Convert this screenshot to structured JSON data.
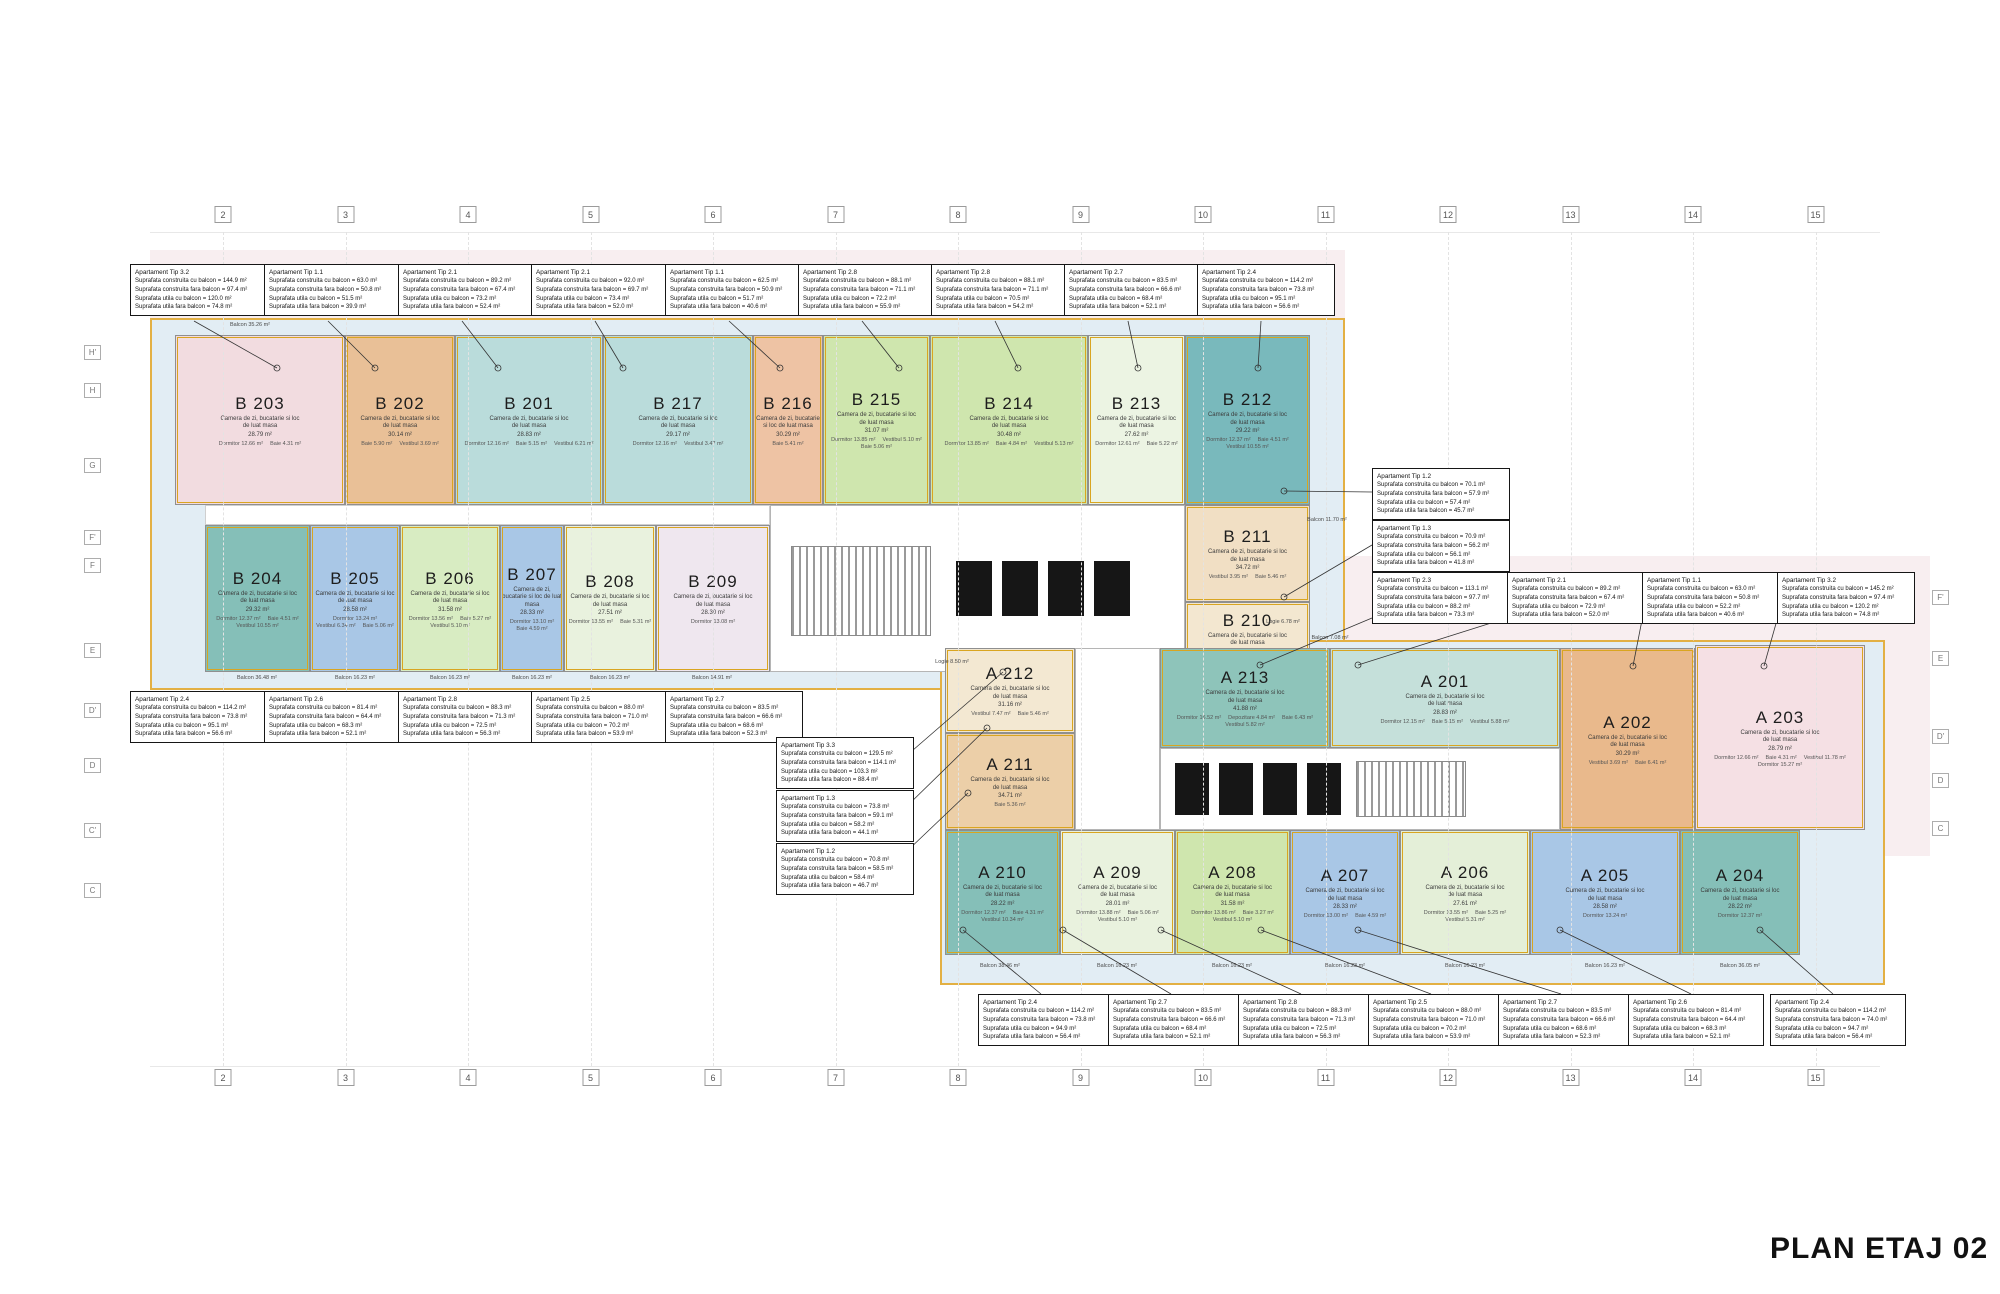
{
  "title": "PLAN ETAJ 02",
  "shared": {
    "main_room_label": "Camera de zi, bucatarie si loc de luat masa",
    "area_unit": "m²",
    "field_labels": [
      "Suprafata construita cu balcon",
      "Suprafata construita fara balcon",
      "Suprafata utila cu balcon",
      "Suprafata utila fara balcon"
    ]
  },
  "annotations": {
    "top": [
      {
        "tip": "Apartament Tip 3.2",
        "values": [
          "144.9",
          "97.4",
          "120.0",
          "74.8"
        ]
      },
      {
        "tip": "Apartament Tip 1.1",
        "values": [
          "63.0",
          "50.8",
          "51.5",
          "39.9"
        ]
      },
      {
        "tip": "Apartament Tip 2.1",
        "values": [
          "89.2",
          "67.4",
          "73.2",
          "52.4"
        ]
      },
      {
        "tip": "Apartament Tip 2.1",
        "values": [
          "92.0",
          "69.7",
          "73.4",
          "52.0"
        ]
      },
      {
        "tip": "Apartament Tip 1.1",
        "values": [
          "62.5",
          "50.9",
          "51.7",
          "40.6"
        ]
      },
      {
        "tip": "Apartament Tip 2.8",
        "values": [
          "88.1",
          "71.1",
          "72.2",
          "55.9"
        ]
      },
      {
        "tip": "Apartament Tip 2.8",
        "values": [
          "88.1",
          "71.1",
          "70.5",
          "54.2"
        ]
      },
      {
        "tip": "Apartament Tip 2.7",
        "values": [
          "83.5",
          "66.6",
          "68.4",
          "52.1"
        ]
      },
      {
        "tip": "Apartament Tip 2.4",
        "values": [
          "114.2",
          "73.8",
          "95.1",
          "56.6"
        ]
      }
    ],
    "right_stack": [
      {
        "tip": "Apartament Tip 1.2",
        "values": [
          "70.1",
          "57.9",
          "57.4",
          "45.7"
        ]
      },
      {
        "tip": "Apartament Tip 1.3",
        "values": [
          "70.9",
          "56.2",
          "56.1",
          "41.8"
        ]
      }
    ],
    "right_row": [
      {
        "tip": "Apartament Tip 2.3",
        "values": [
          "113.1",
          "97.7",
          "88.2",
          "73.3"
        ]
      },
      {
        "tip": "Apartament Tip 2.1",
        "values": [
          "89.2",
          "67.4",
          "72.9",
          "52.0"
        ]
      },
      {
        "tip": "Apartament Tip 1.1",
        "values": [
          "63.0",
          "50.8",
          "52.2",
          "40.6"
        ]
      },
      {
        "tip": "Apartament Tip 3.2",
        "values": [
          "145.2",
          "97.4",
          "120.2",
          "74.8"
        ]
      }
    ],
    "left_row": [
      {
        "tip": "Apartament Tip 2.4",
        "values": [
          "114.2",
          "73.8",
          "95.1",
          "56.6"
        ]
      },
      {
        "tip": "Apartament Tip 2.6",
        "values": [
          "81.4",
          "64.4",
          "68.3",
          "52.1"
        ]
      },
      {
        "tip": "Apartament Tip 2.8",
        "values": [
          "88.3",
          "71.3",
          "72.5",
          "56.3"
        ]
      },
      {
        "tip": "Apartament Tip 2.5",
        "values": [
          "88.0",
          "71.0",
          "70.2",
          "53.9"
        ]
      },
      {
        "tip": "Apartament Tip 2.7",
        "values": [
          "83.5",
          "66.6",
          "68.6",
          "52.3"
        ]
      }
    ],
    "mid_stack": [
      {
        "tip": "Apartament Tip 3.3",
        "values": [
          "129.5",
          "114.1",
          "103.3",
          "88.4"
        ]
      },
      {
        "tip": "Apartament Tip 1.3",
        "values": [
          "73.8",
          "59.1",
          "58.2",
          "44.1"
        ]
      },
      {
        "tip": "Apartament Tip 1.2",
        "values": [
          "70.8",
          "58.5",
          "58.4",
          "46.7"
        ]
      }
    ],
    "bottom_row": [
      {
        "tip": "Apartament Tip 2.4",
        "values": [
          "114.2",
          "73.8",
          "94.9",
          "56.4"
        ]
      },
      {
        "tip": "Apartament Tip 2.7",
        "values": [
          "83.5",
          "66.6",
          "68.4",
          "52.1"
        ]
      },
      {
        "tip": "Apartament Tip 2.8",
        "values": [
          "88.3",
          "71.3",
          "72.5",
          "56.3"
        ]
      },
      {
        "tip": "Apartament Tip 2.5",
        "values": [
          "88.0",
          "71.0",
          "70.2",
          "53.9"
        ]
      },
      {
        "tip": "Apartament Tip 2.7",
        "values": [
          "83.5",
          "66.6",
          "68.6",
          "52.3"
        ]
      },
      {
        "tip": "Apartament Tip 2.6",
        "values": [
          "81.4",
          "64.4",
          "68.3",
          "52.1"
        ]
      },
      {
        "tip": "Apartament Tip 2.4",
        "values": [
          "114.2",
          "74.0",
          "94.7",
          "56.4"
        ]
      }
    ]
  },
  "units": [
    {
      "id": "B 203",
      "color": "#f2dce0",
      "main_area": "28.79",
      "rooms": [
        {
          "n": "Dormitor",
          "a": "12.66"
        },
        {
          "n": "Baie",
          "a": "4.31"
        }
      ]
    },
    {
      "id": "B 202",
      "color": "#e9c097",
      "main_area": "30.14",
      "rooms": [
        {
          "n": "Baie",
          "a": "5.90"
        },
        {
          "n": "Vestibul",
          "a": "3.69"
        }
      ]
    },
    {
      "id": "B 201",
      "color": "#badcdb",
      "main_area": "28.83",
      "rooms": [
        {
          "n": "Dormitor",
          "a": "12.16"
        },
        {
          "n": "Baie",
          "a": "5.15"
        },
        {
          "n": "Vestibul",
          "a": "6.21"
        }
      ]
    },
    {
      "id": "B 217",
      "color": "#badcdb",
      "main_area": "29.17",
      "rooms": [
        {
          "n": "Dormitor",
          "a": "12.16"
        },
        {
          "n": "Vestibul",
          "a": "3.47"
        }
      ]
    },
    {
      "id": "B 216",
      "color": "#eec3a4",
      "main_area": "30.29",
      "rooms": [
        {
          "n": "Baie",
          "a": "5.41"
        }
      ]
    },
    {
      "id": "B 215",
      "color": "#cfe6ae",
      "main_area": "31.07",
      "rooms": [
        {
          "n": "Dormitor",
          "a": "13.85"
        },
        {
          "n": "Vestibul",
          "a": "5.10"
        },
        {
          "n": "Baie",
          "a": "5.06"
        }
      ]
    },
    {
      "id": "B 214",
      "color": "#cfe6ae",
      "main_area": "30.48",
      "rooms": [
        {
          "n": "Dormitor",
          "a": "13.85"
        },
        {
          "n": "Baie",
          "a": "4.84"
        },
        {
          "n": "Vestibul",
          "a": "5.13"
        }
      ]
    },
    {
      "id": "B 213",
      "color": "#ecf4e3",
      "main_area": "27.62",
      "rooms": [
        {
          "n": "Dormitor",
          "a": "12.61"
        },
        {
          "n": "Baie",
          "a": "5.22"
        }
      ]
    },
    {
      "id": "B 212",
      "color": "#79b9bc",
      "main_area": "29.22",
      "rooms": [
        {
          "n": "Dormitor",
          "a": "12.37"
        },
        {
          "n": "Baie",
          "a": "4.51"
        },
        {
          "n": "Vestibul",
          "a": "10.55"
        }
      ]
    },
    {
      "id": "B 204",
      "color": "#85bfb8",
      "main_area": "29.32",
      "rooms": [
        {
          "n": "Dormitor",
          "a": "12.37"
        },
        {
          "n": "Baie",
          "a": "4.51"
        },
        {
          "n": "Vestibul",
          "a": "10.55"
        }
      ]
    },
    {
      "id": "B 205",
      "color": "#a9c7e6",
      "main_area": "28.58",
      "rooms": [
        {
          "n": "Dormitor",
          "a": "13.24"
        },
        {
          "n": "Vestibul",
          "a": "6.34"
        },
        {
          "n": "Baie",
          "a": "5.06"
        }
      ]
    },
    {
      "id": "B 206",
      "color": "#d8ecc2",
      "main_area": "31.58",
      "rooms": [
        {
          "n": "Dormitor",
          "a": "13.56"
        },
        {
          "n": "Baie",
          "a": "5.27"
        },
        {
          "n": "Vestibul",
          "a": "5.10"
        }
      ]
    },
    {
      "id": "B 207",
      "color": "#a9c7e6",
      "main_area": "28.33",
      "rooms": [
        {
          "n": "Dormitor",
          "a": "13.10"
        },
        {
          "n": "Baie",
          "a": "4.59"
        }
      ]
    },
    {
      "id": "B 208",
      "color": "#e9f2de",
      "main_area": "27.51",
      "rooms": [
        {
          "n": "Dormitor",
          "a": "13.55"
        },
        {
          "n": "Baie",
          "a": "5.31"
        }
      ]
    },
    {
      "id": "B 209",
      "color": "#efe7ef",
      "main_area": "28.30",
      "rooms": [
        {
          "n": "Dormitor",
          "a": "13.08"
        }
      ]
    },
    {
      "id": "B 211",
      "color": "#f1dfc4",
      "main_area": "34.72",
      "rooms": [
        {
          "n": "Vestibul",
          "a": "3.95"
        },
        {
          "n": "Baie",
          "a": "5.46"
        }
      ]
    },
    {
      "id": "B 210",
      "color": "#f3e7d0",
      "main_area": "30.15",
      "rooms": [
        {
          "n": "Baie",
          "a": "4.93"
        },
        {
          "n": "Vestibul",
          "a": "8.67"
        }
      ]
    },
    {
      "id": "A 212",
      "color": "#f3e8d2",
      "main_area": "31.16",
      "rooms": [
        {
          "n": "Vestibul",
          "a": "7.47"
        },
        {
          "n": "Baie",
          "a": "5.46"
        }
      ]
    },
    {
      "id": "A 211",
      "color": "#eccfa8",
      "main_area": "34.71",
      "rooms": [
        {
          "n": "Baie",
          "a": "5.36"
        }
      ]
    },
    {
      "id": "A 213",
      "color": "#8ec4ba",
      "main_area": "41.88",
      "rooms": [
        {
          "n": "Dormitor",
          "a": "16.52"
        },
        {
          "n": "Depozitare",
          "a": "4.84"
        },
        {
          "n": "Baie",
          "a": "6.43"
        },
        {
          "n": "Vestibul",
          "a": "5.82"
        }
      ]
    },
    {
      "id": "A 201",
      "color": "#c5e0da",
      "main_area": "28.83",
      "rooms": [
        {
          "n": "Dormitor",
          "a": "12.15"
        },
        {
          "n": "Baie",
          "a": "5.15"
        },
        {
          "n": "Vestibul",
          "a": "5.88"
        }
      ]
    },
    {
      "id": "A 202",
      "color": "#e9b98c",
      "main_area": "30.29",
      "rooms": [
        {
          "n": "Vestibul",
          "a": "3.69"
        },
        {
          "n": "Baie",
          "a": "6.41"
        }
      ]
    },
    {
      "id": "A 203",
      "color": "#f5e0e4",
      "main_area": "28.79",
      "rooms": [
        {
          "n": "Dormitor",
          "a": "12.66"
        },
        {
          "n": "Baie",
          "a": "4.31"
        },
        {
          "n": "Vestibul",
          "a": "11.78"
        },
        {
          "n": "Dormitor",
          "a": "15.27"
        }
      ]
    },
    {
      "id": "A 210",
      "color": "#85bfb8",
      "main_area": "28.22",
      "rooms": [
        {
          "n": "Dormitor",
          "a": "12.37"
        },
        {
          "n": "Baie",
          "a": "4.31"
        },
        {
          "n": "Vestibul",
          "a": "10.34"
        }
      ]
    },
    {
      "id": "A 209",
      "color": "#e9f2de",
      "main_area": "28.01",
      "rooms": [
        {
          "n": "Dormitor",
          "a": "13.88"
        },
        {
          "n": "Baie",
          "a": "5.06"
        },
        {
          "n": "Vestibul",
          "a": "5.10"
        }
      ]
    },
    {
      "id": "A 208",
      "color": "#cfe6ae",
      "main_area": "31.58",
      "rooms": [
        {
          "n": "Dormitor",
          "a": "13.86"
        },
        {
          "n": "Baie",
          "a": "3.27"
        },
        {
          "n": "Vestibul",
          "a": "5.10"
        }
      ]
    },
    {
      "id": "A 207",
      "color": "#a9c7e6",
      "main_area": "28.33",
      "rooms": [
        {
          "n": "Dormitor",
          "a": "13.00"
        },
        {
          "n": "Baie",
          "a": "4.59"
        }
      ]
    },
    {
      "id": "A 206",
      "color": "#e4efd8",
      "main_area": "27.61",
      "rooms": [
        {
          "n": "Dormitor",
          "a": "13.55"
        },
        {
          "n": "Baie",
          "a": "5.25"
        },
        {
          "n": "Vestibul",
          "a": "5.31"
        }
      ]
    },
    {
      "id": "A 205",
      "color": "#a9c7e6",
      "main_area": "28.58",
      "rooms": [
        {
          "n": "Dormitor",
          "a": "13.24"
        }
      ]
    },
    {
      "id": "A 204",
      "color": "#85bfb8",
      "main_area": "28.22",
      "rooms": [
        {
          "n": "Dormitor",
          "a": "12.37"
        }
      ]
    }
  ],
  "balcony_labels": [
    "Balcon 35.26 m²",
    "Balcon 36.48 m²",
    "Balcon 16.23 m²",
    "Balcon 16.23 m²",
    "Balcon 16.23 m²",
    "Balcon 16.23 m²",
    "Balcon 14.91 m²",
    "Balcon 11.70 m²",
    "Logie 6.78 m²",
    "Balcon 7.08 m²",
    "Logie 8.50 m²",
    "Balcon 38.46 m²",
    "Balcon 16.23 m²",
    "Balcon 16.23 m²",
    "Balcon 16.23 m²",
    "Balcon 16.23 m²",
    "Balcon 16.23 m²",
    "Balcon 36.05 m²"
  ],
  "grid": {
    "columns": [
      "2",
      "3",
      "4",
      "5",
      "6",
      "7",
      "8",
      "9",
      "10",
      "11",
      "12",
      "13",
      "14",
      "15"
    ],
    "rows_left": [
      "H'",
      "H",
      "G",
      "F'",
      "F",
      "E",
      "D'",
      "D",
      "C'",
      "C"
    ],
    "rows_right": [
      "F'",
      "E",
      "D'",
      "D",
      "C"
    ]
  }
}
